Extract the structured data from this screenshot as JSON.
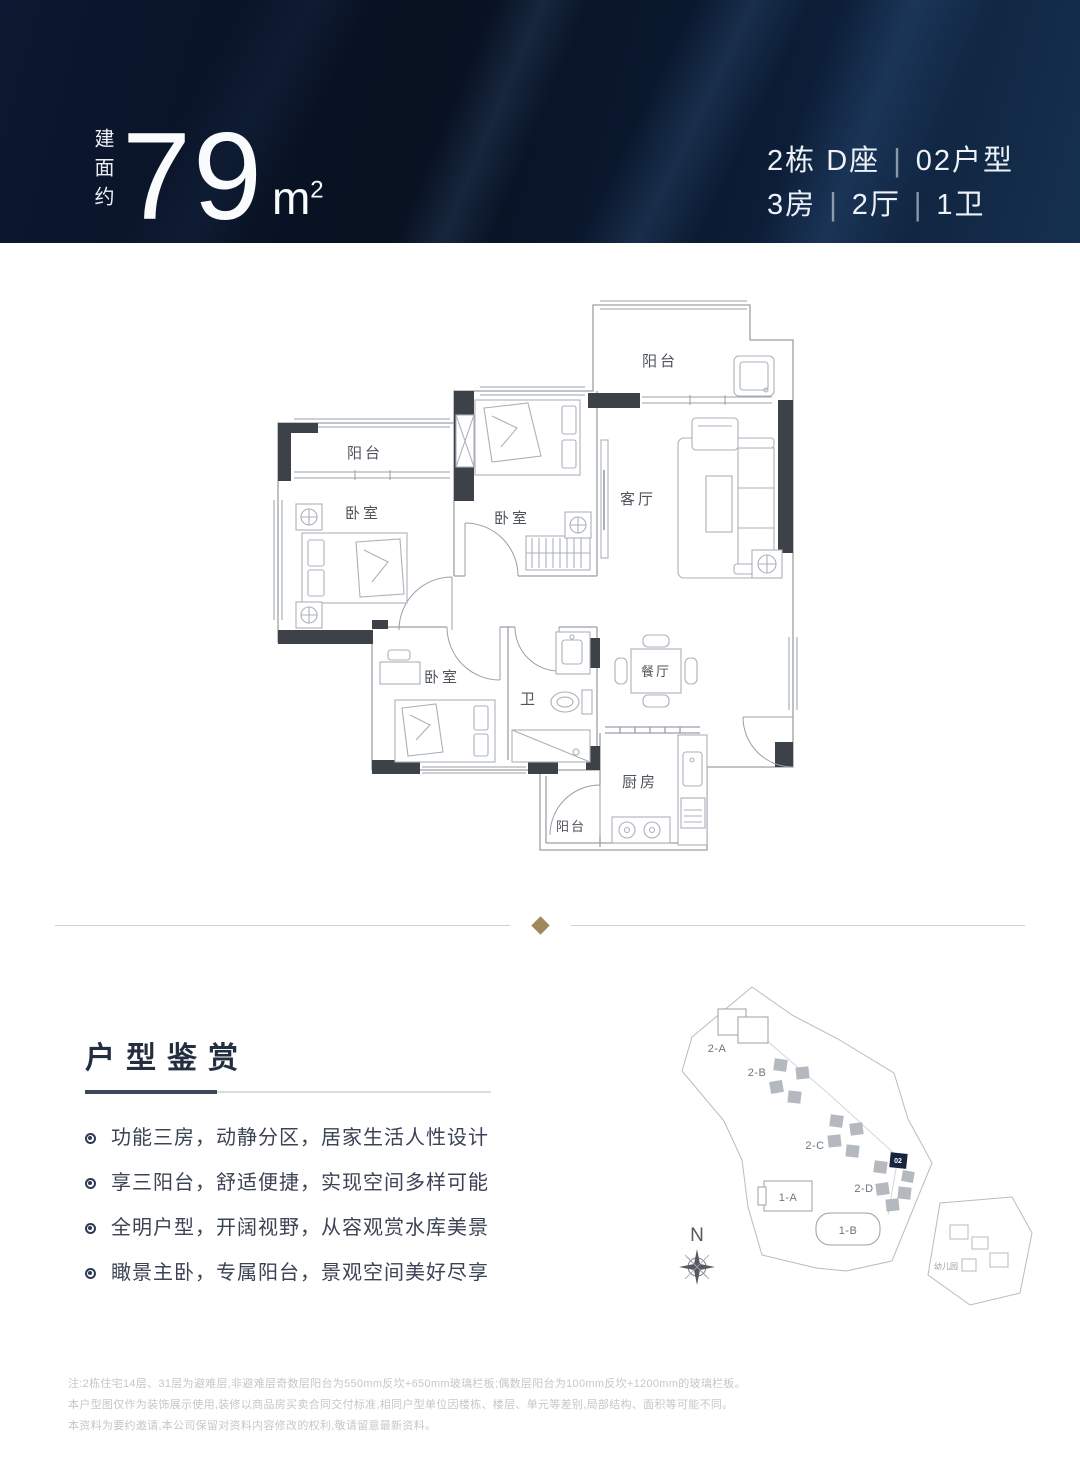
{
  "banner": {
    "area_prefix": "建面约",
    "area_value": "79",
    "area_unit_base": "m",
    "area_unit_sup": "2",
    "building": "2栋 D座",
    "unit_type": "02户型",
    "rooms": "3房",
    "halls": "2厅",
    "baths": "1卫",
    "separator": "|",
    "bg_color": "#0a1425",
    "text_color": "#f3f6fa"
  },
  "floor_plan": {
    "labels": {
      "top_balcony": "阳台",
      "living_room": "客厅",
      "left_balcony": "阳台",
      "bedroom_left": "卧室",
      "bedroom_middle": "卧室",
      "bedroom_bottom": "卧室",
      "bathroom": "卫",
      "dining_room": "餐厅",
      "kitchen": "厨房",
      "bottom_balcony": "阳台"
    },
    "wall_color": "#3d4148",
    "line_color": "#9aa0a6"
  },
  "features": {
    "title": "户型鉴赏",
    "items": [
      "功能三房，动静分区，居家生活人性设计",
      "享三阳台，舒适便捷，实现空间多样可能",
      "全明户型，开阔视野，从容观赏水库美景",
      "瞰景主卧，专属阳台，景观空间美好尽享"
    ],
    "accent_color": "#3c4759"
  },
  "site_map": {
    "buildings": {
      "b2a": "2-A",
      "b2b": "2-B",
      "b2c": "2-C",
      "b2d": "2-D",
      "b1a": "1-A",
      "b1b": "1-B"
    },
    "selected_unit": "02",
    "selected_color": "#16243e",
    "kindergarten": "幼儿园",
    "compass": "N"
  },
  "divider": {
    "diamond_color": "#a1875c",
    "line_color": "#d8d1c2"
  },
  "disclaimer": {
    "lines": [
      "注:2栋住宅14层、31层为避难层,非避难层奇数层阳台为550mm反坎+650mm玻璃栏板;偶数层阳台为100mm反坎+1200mm的玻璃栏板。",
      "本户型图仅作为装饰展示使用,装修以商品房买卖合同交付标准,相同户型单位因楼栋、楼层、单元等差别,局部结构、面积等可能不同。",
      "本资料为要约邀请,本公司保留对资料内容修改的权利,敬请留意最新资料。"
    ]
  }
}
